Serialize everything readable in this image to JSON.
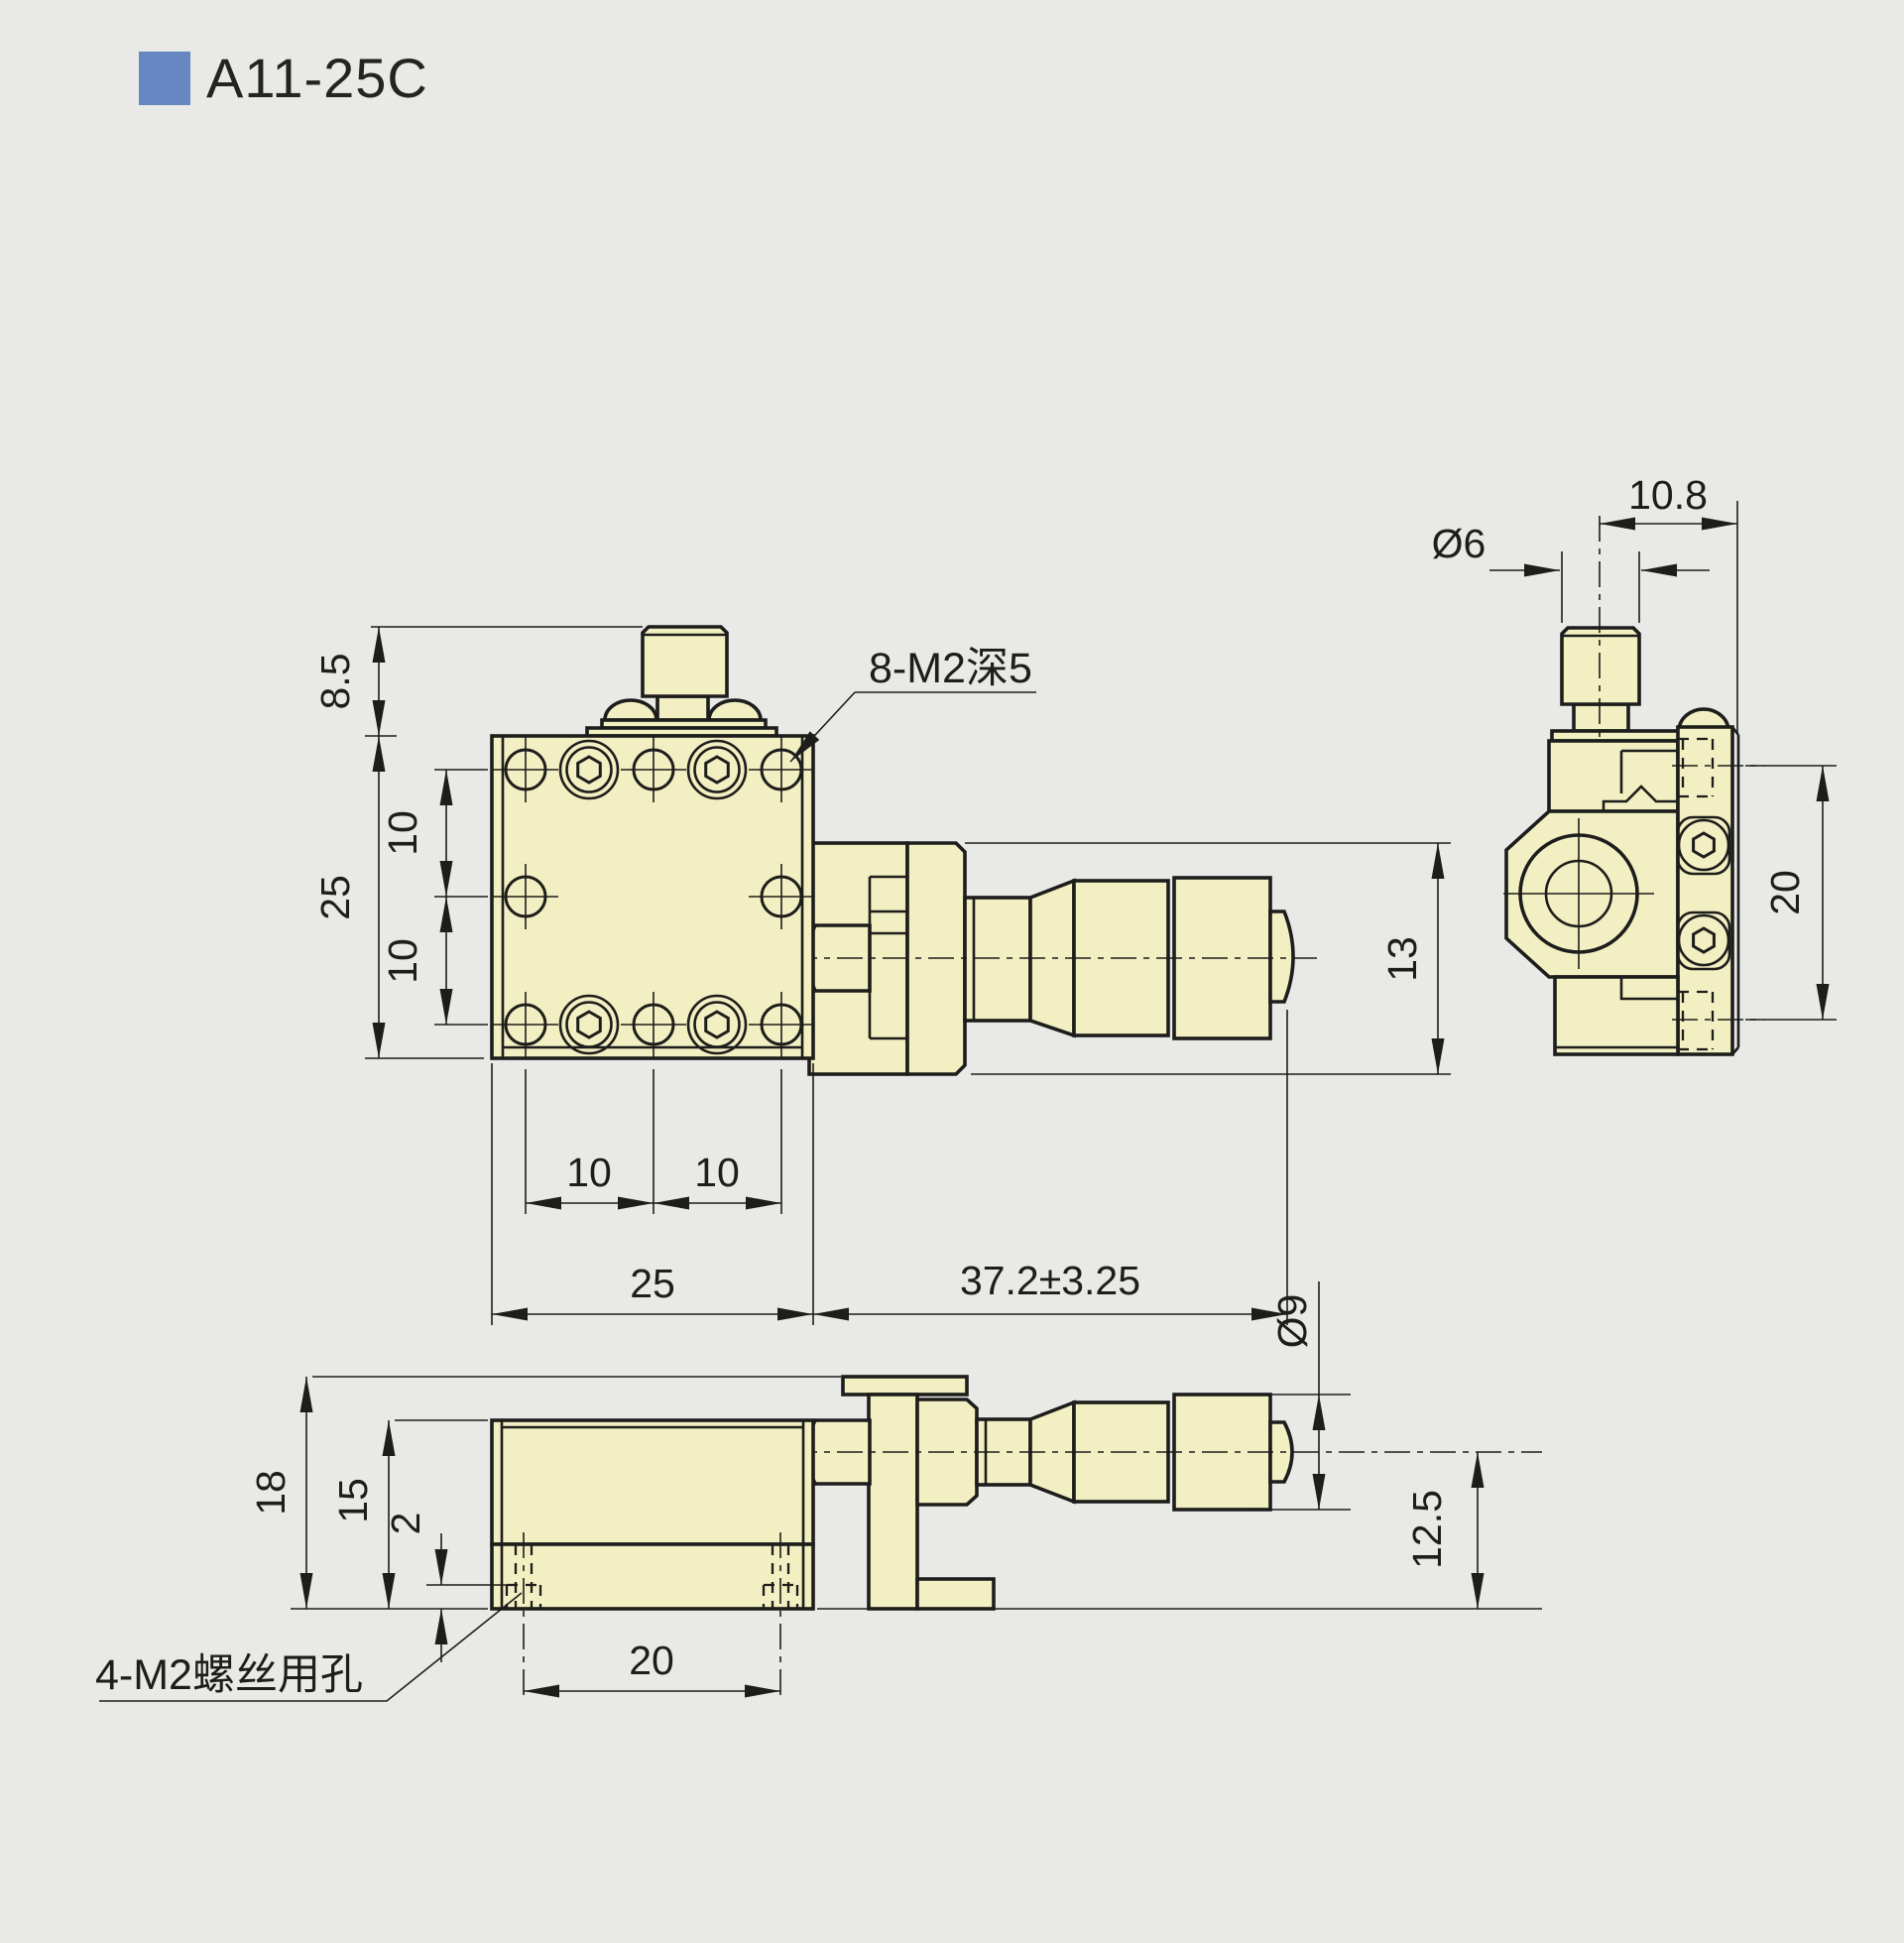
{
  "title": "A11-25C",
  "front_view": {
    "dim_knob_height": "8.5",
    "dim_body_height": "25",
    "dim_hole_pitch_v1": "10",
    "dim_hole_pitch_v2": "10",
    "dim_hole_pitch_h1": "10",
    "dim_hole_pitch_h2": "10",
    "dim_body_width": "25",
    "dim_micrometer_travel": "37.2±3.25",
    "dim_bracket_height": "13",
    "note_platform_holes": "8-M2深5"
  },
  "side_view": {
    "dim_axis_to_face": "10.8",
    "dim_knob_diameter": "Ø6",
    "dim_side_hole_pitch": "20"
  },
  "bottom_view": {
    "dim_total_height": "18",
    "dim_body_height": "15",
    "dim_hole_offset": "2",
    "dim_base_hole_pitch": "20",
    "dim_thimble_diameter": "Ø9",
    "dim_axis_height": "12.5",
    "note_base_holes": "4-M2螺丝用孔"
  },
  "colors": {
    "background": "#e9e9e7",
    "part_fill": "#f2efc3",
    "line": "#1d1d1b",
    "accent_blue": "#6687c2"
  }
}
